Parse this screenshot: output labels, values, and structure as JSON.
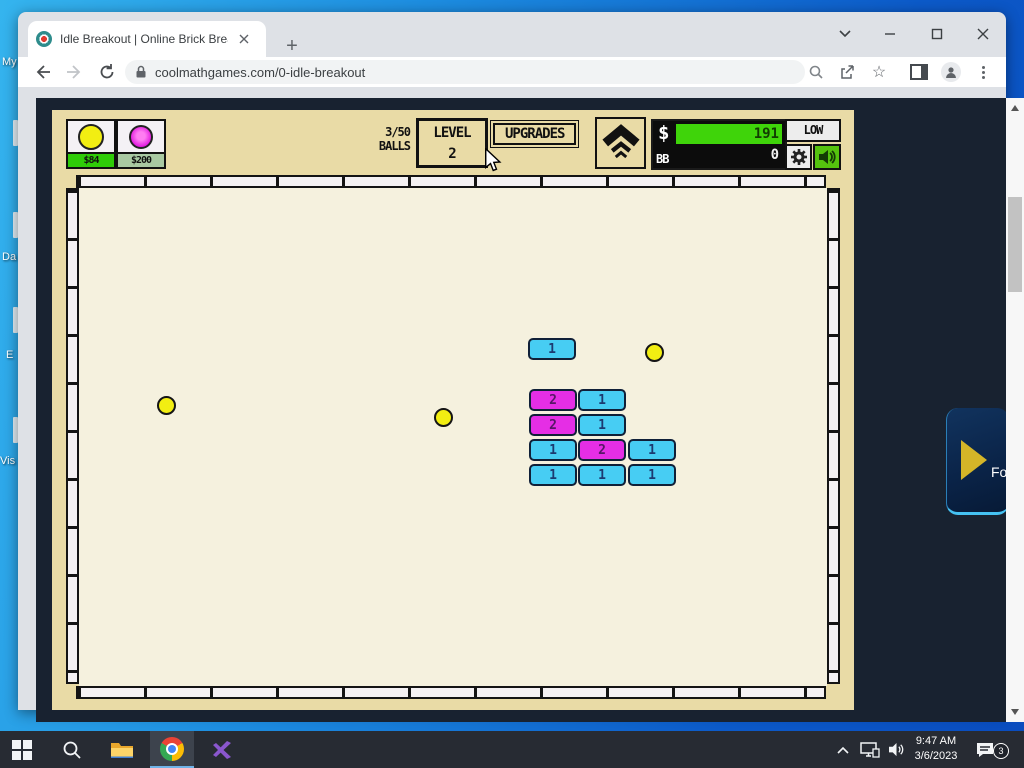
{
  "desktop": {
    "icon_labels": [
      {
        "text": "My",
        "x": 2,
        "y": 56
      },
      {
        "text": "Da",
        "x": 2,
        "y": 251
      },
      {
        "text": "E",
        "x": 6,
        "y": 349
      },
      {
        "text": "Vis",
        "x": 0,
        "y": 455
      }
    ]
  },
  "browser": {
    "tab_title": "Idle Breakout | Online Brick Break",
    "url": "coolmathgames.com/0-idle-breakout"
  },
  "game": {
    "shop": [
      {
        "price": "$84",
        "ball": "yellow",
        "affordable": true
      },
      {
        "price": "$200",
        "ball": "magenta",
        "affordable": false
      }
    ],
    "balls_counter": {
      "count": "3/50",
      "label": "BALLS"
    },
    "level": {
      "label": "LEVEL",
      "value": "2"
    },
    "upgrades_label": "UPGRADES",
    "money": {
      "symbol": "$",
      "cash": "191",
      "bb_label": "BB",
      "bb_value": "0"
    },
    "quality_label": "LOW",
    "bricks": [
      {
        "x": 510,
        "y": 326,
        "type": "cyan",
        "value": "1"
      },
      {
        "x": 511,
        "y": 377,
        "type": "magenta",
        "value": "2"
      },
      {
        "x": 560,
        "y": 377,
        "type": "cyan",
        "value": "1"
      },
      {
        "x": 511,
        "y": 402,
        "type": "magenta",
        "value": "2"
      },
      {
        "x": 560,
        "y": 402,
        "type": "cyan",
        "value": "1"
      },
      {
        "x": 511,
        "y": 427,
        "type": "cyan",
        "value": "1"
      },
      {
        "x": 560,
        "y": 427,
        "type": "magenta",
        "value": "2"
      },
      {
        "x": 610,
        "y": 427,
        "type": "cyan",
        "value": "1"
      },
      {
        "x": 511,
        "y": 452,
        "type": "cyan",
        "value": "1"
      },
      {
        "x": 560,
        "y": 452,
        "type": "cyan",
        "value": "1"
      },
      {
        "x": 610,
        "y": 452,
        "type": "cyan",
        "value": "1"
      }
    ],
    "balls": [
      {
        "x": 148,
        "y": 393
      },
      {
        "x": 425,
        "y": 405
      },
      {
        "x": 636,
        "y": 340
      }
    ]
  },
  "overlay": {
    "partial_text": "Fo"
  },
  "taskbar": {
    "time": "9:47 AM",
    "date": "3/6/2023",
    "notification_count": "3"
  },
  "colors": {
    "brick_cyan": "#47cdf3",
    "brick_magenta": "#e52ee5",
    "brick_text_cyan": "#1c3a70",
    "brick_text_magenta": "#571666",
    "ball_yellow": "#f2ee12",
    "money_green": "#3fd40a",
    "canvas_tan": "#e9dba6",
    "page_bg": "#182230"
  }
}
